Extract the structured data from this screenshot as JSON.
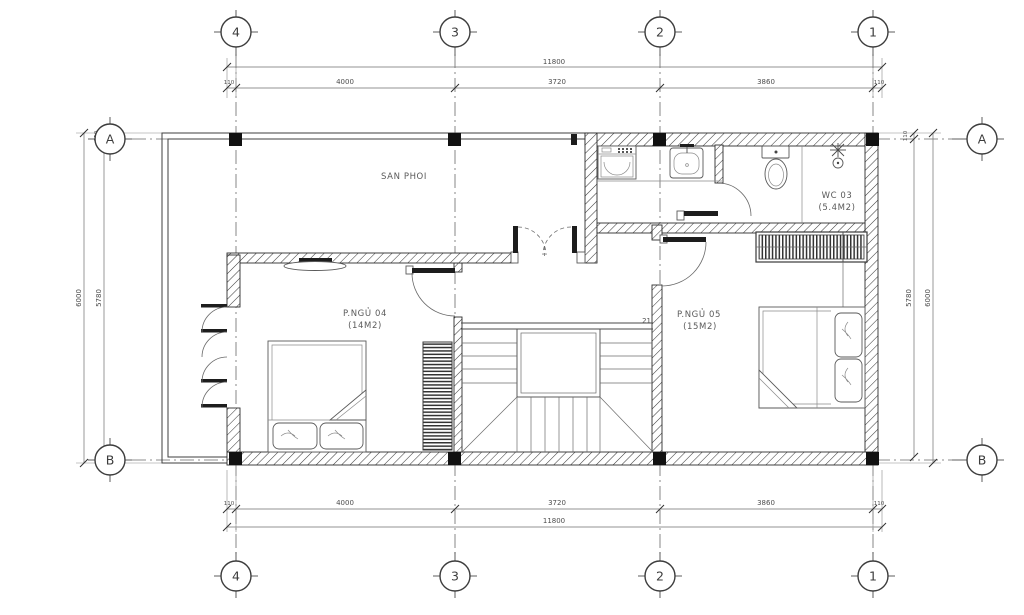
{
  "grid": {
    "cols": [
      "4",
      "3",
      "2",
      "1"
    ],
    "rows": [
      "A",
      "B"
    ]
  },
  "dims": {
    "top": {
      "total": "11800",
      "segs": [
        "110",
        "4000",
        "3720",
        "3860",
        "110"
      ]
    },
    "bottom": {
      "total": "11800",
      "segs": [
        "110",
        "4000",
        "3720",
        "3860",
        "110"
      ]
    },
    "left": {
      "overall": "6000",
      "inner": "5780",
      "offset": "110"
    },
    "right": {
      "overall": "6000",
      "inner": "5780",
      "offset": "110"
    }
  },
  "rooms": {
    "terrace": {
      "name": "SAN PHOI"
    },
    "bed4": {
      "name": "P.NGỦ 04",
      "area": "(14M2)"
    },
    "bed5": {
      "name": "P.NGỦ 05",
      "area": "(15M2)"
    },
    "wc": {
      "name": "WC 03",
      "area": "(5.4M2)"
    }
  },
  "stairs": {
    "top_step": "21"
  },
  "colors": {
    "line": "#2e2e2e",
    "paper": "#ffffff"
  }
}
